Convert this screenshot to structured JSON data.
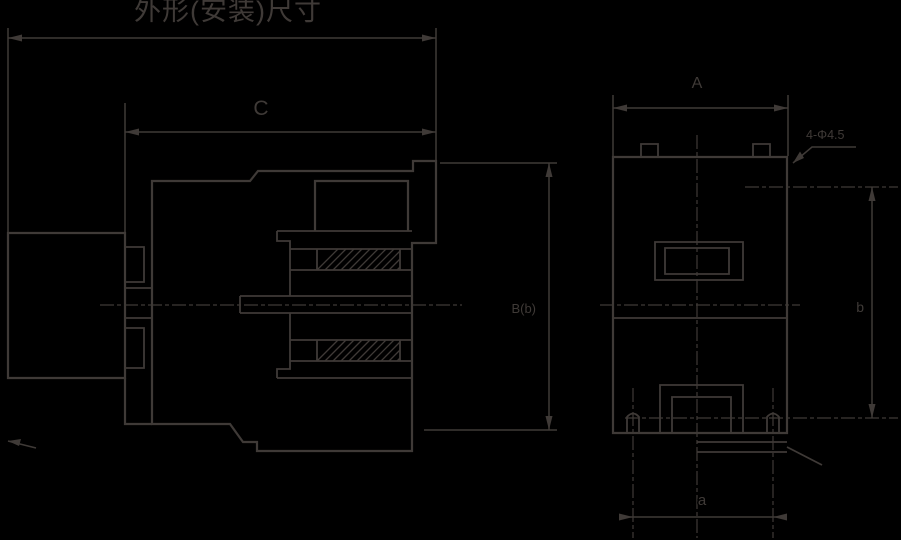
{
  "drawing": {
    "background_color": "#000000",
    "line_color": "#3f3a37",
    "views": {
      "side_view": {
        "title_label": "外形(安装)尺寸",
        "depth_dim_label": "C",
        "height_dim_label": "B(b)"
      },
      "front_view": {
        "width_dim_label": "A",
        "mounting_holes_label": "4-Φ4.5",
        "vertical_spacing_label": "b",
        "horizontal_spacing_label": "a"
      }
    }
  }
}
